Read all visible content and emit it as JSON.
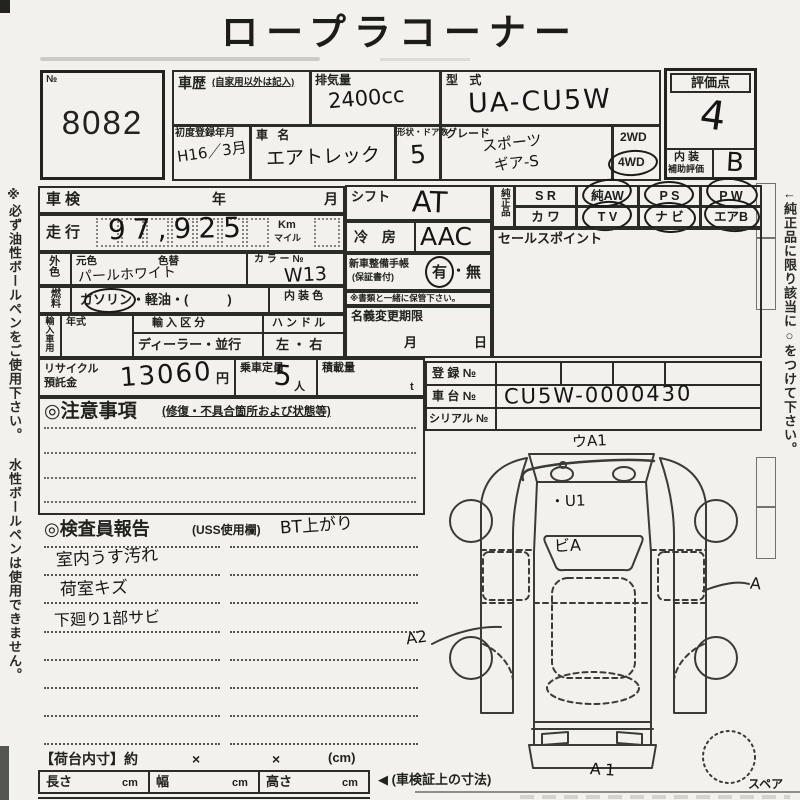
{
  "title": "ロープラコーナー",
  "side_notes": {
    "left": "※必ず油性ボールペンをご使用下さい。 水性ボールペンは使用できません。",
    "right": "←純正品に限り該当に○をつけて下さい。"
  },
  "lot": {
    "no_symbol": "№",
    "number": "8082"
  },
  "header": {
    "history_label": "車歴",
    "history_note": "(自家用以外は記入)",
    "displacement_label": "排気量",
    "displacement_value": "2400cc",
    "model_code_label": "型 式",
    "model_code_value": "UA-CU5W",
    "first_reg_label": "初度登録年月",
    "first_reg_value": "H16／3月",
    "car_name_label": "車 名",
    "car_name_value": "エアトレック",
    "doors_label": "形状・ドア数",
    "doors_value": "5",
    "grade_label": "グレード",
    "grade_line1": "スポーツ",
    "grade_line2": "ギア-S",
    "drive_2wd": "2WD",
    "drive_4wd": "4WD"
  },
  "evaluation": {
    "label": "評価点",
    "score": "4",
    "interior_line1": "内 装",
    "interior_line2": "補助評価",
    "interior_grade": "B"
  },
  "specs": {
    "shaken_label": "車検",
    "shaken_year": "年",
    "shaken_month": "月",
    "mileage_label": "走行",
    "mileage_value": "97,925",
    "mileage_unit_top": "Km",
    "mileage_unit_bottom": "マイル",
    "ext_color_label": "外色",
    "base_color_label": "元色",
    "base_color_value": "パールホワイト",
    "color_change_label": "色替",
    "color_no_label": "カ ラ ー №",
    "color_no_value": "W13",
    "fuel_label": "燃料",
    "fuel_options": "ガソリン・軽油・(　　　)",
    "interior_color_label": "内 装 色",
    "import_label": "輸入車用",
    "import_year_label": "年式",
    "import_class_label": "輸 入 区 分",
    "import_class_value": "ディーラー・並行",
    "handle_label": "ハ ン ド ル",
    "handle_value": "左 ・ 右",
    "recycle_label1": "リサイクル",
    "recycle_label2": "預託金",
    "recycle_value": "13060",
    "recycle_unit": "円",
    "capacity_label": "乗車定員",
    "capacity_value": "5",
    "capacity_unit": "人",
    "load_label": "積載量",
    "load_unit": "t"
  },
  "attention": {
    "heading": "◎注意事項",
    "subheading": "(修復・不具合箇所および状態等)"
  },
  "inspector": {
    "heading": "◎検査員報告",
    "subheading": "(USS使用欄)",
    "top_note": "BT上がり",
    "notes": [
      "室内うす汚れ",
      "荷室キズ",
      "下廻り1部サビ"
    ]
  },
  "equipment": {
    "shift_label": "シフト",
    "shift_value": "AT",
    "ac_label": "冷 房",
    "ac_value": "AAC",
    "book_label1": "新車整備手帳",
    "book_label2": "(保証書付)",
    "book_yes": "有",
    "book_dot": "・",
    "book_no": "無",
    "book_note": "※書類と一緒に保管下さい。",
    "name_change_label": "名義変更期限",
    "name_change_month": "月",
    "name_change_day": "日"
  },
  "genuine": {
    "label": "純正品",
    "row1": [
      "S R",
      "純AW",
      "P S",
      "P W"
    ],
    "row2": [
      "カ ワ",
      "T V",
      "ナ ビ",
      "エアB"
    ]
  },
  "sales_point_label": "セールスポイント",
  "registration": {
    "reg_label": "登 録 №",
    "chassis_label": "車 台 №",
    "chassis_value": "CU5W-0000430",
    "serial_label": "シリアル №"
  },
  "diagram": {
    "mark_front_bumper": "ウA1",
    "mark_hood": "・U1",
    "mark_windshield": "ビA",
    "mark_right_side": "A",
    "mark_left_rear": "A2",
    "mark_rear_bumper": "A1",
    "spare_label": "スペア"
  },
  "cargo": {
    "heading": "【荷台内寸】約",
    "times1": "×",
    "times2": "×",
    "unit": "(cm)",
    "length_label": "長さ",
    "width_label": "幅",
    "height_label": "高さ",
    "cm1": "cm",
    "cm2": "cm",
    "cm3": "cm",
    "arrow_note": "◀ (車検証上の寸法)"
  }
}
